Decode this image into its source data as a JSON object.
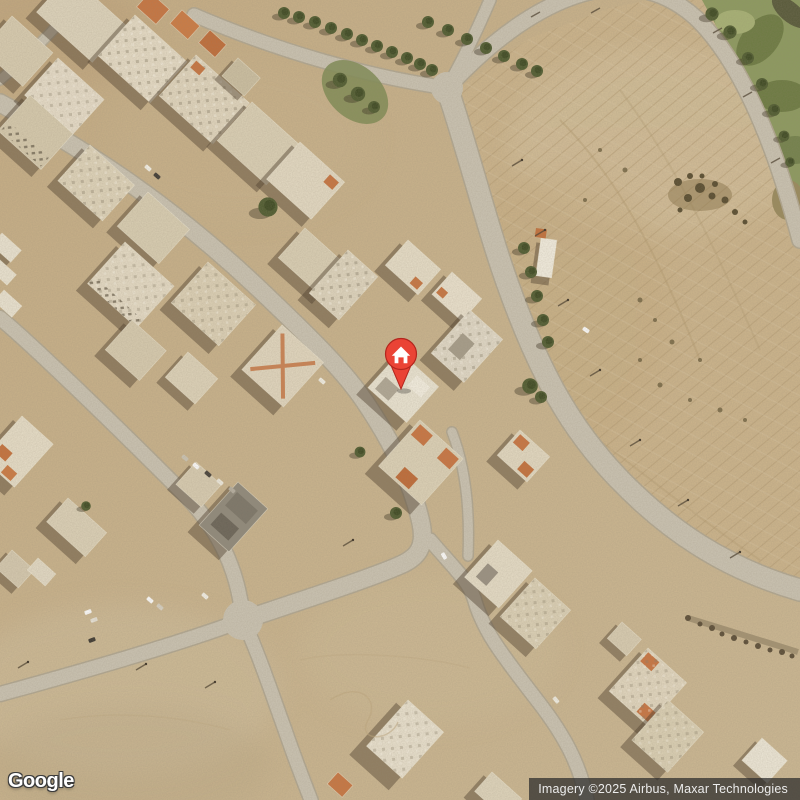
{
  "map": {
    "view_type": "satellite",
    "marker": {
      "name": "home-place-marker",
      "shape": "pin",
      "fill": "#EA4335",
      "border": "#B3261E",
      "glyph": "house",
      "glyph_color": "#FFFFFF",
      "x": 401,
      "y": 360
    },
    "palette": {
      "sand": "#c9b28b",
      "road": "#cbc4b3",
      "road_edge": "#b2a892",
      "roof_light": "#eae2cf",
      "roof_cream": "#ddd2b8",
      "roof_orange": "#c8743f",
      "roof_gray": "#8f897b",
      "shadow": "#463826",
      "tree": "#4d5a2e",
      "green_strip": "#8c9a5e",
      "field": "#cdb58c"
    }
  },
  "watermark": {
    "logo_text": "Google"
  },
  "attribution": {
    "text": "Imagery ©2025 Airbus, Maxar Technologies"
  }
}
